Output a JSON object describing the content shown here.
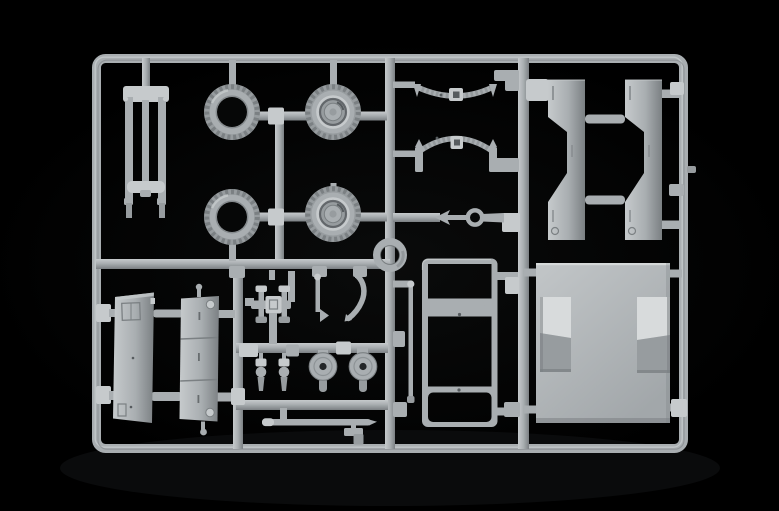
{
  "scene": {
    "description": "Product photograph of an unassembled light-gray injection-molded plastic model kit sprue (parts tree) lying on a black background",
    "background_color": "#000000",
    "material": "light gray polystyrene plastic",
    "frame_shape": "rounded rectangular runner frame with internal vertical and horizontal runners"
  },
  "colors": {
    "background": "#000000",
    "plastic": "#a9aeb1",
    "plastic_light": "#c6cacc",
    "plastic_lighter": "#d8dbdc",
    "plastic_mid": "#979c9f",
    "plastic_dark": "#7b8083",
    "plastic_darker": "#565b5e",
    "hole": "#060707",
    "floor_light": "#c2c6c8",
    "floor_mid": "#a2a7aa",
    "shadow_glow": "#0e0f10"
  },
  "sprue": {
    "rows": [
      {
        "location": "top-left",
        "parts_summary": "ladder-shaped support part with two legs"
      },
      {
        "location": "top-center-left",
        "parts_summary": "two hollow tires and two wheels with molded hubs"
      },
      {
        "location": "top-center",
        "parts_summary": "two curved leaf-spring parts, one bowed down and one arched up"
      },
      {
        "location": "top-right",
        "parts_summary": "two tall notched chassis-rail panels"
      },
      {
        "location": "middle",
        "parts_summary": "towing rod with ring eyelet and a round ring part"
      },
      {
        "location": "bottom-left",
        "parts_summary": "two door panels with hinge and panel detailing"
      },
      {
        "location": "bottom-center",
        "parts_summary": "cluster of small parts: cross fitting, levers, pins, two drilled discs, long thin rod, stepped bracket"
      },
      {
        "location": "bottom-center-right",
        "parts_summary": "three-opening window frame and a thin rod"
      },
      {
        "location": "bottom-right",
        "parts_summary": "large floor panel with two raised box shapes"
      }
    ],
    "parts": [
      {
        "name": "ladder-support-part",
        "count": 1
      },
      {
        "name": "tire",
        "count": 2
      },
      {
        "name": "wheel-with-hub",
        "count": 2
      },
      {
        "name": "leaf-spring-bowed-down",
        "count": 1
      },
      {
        "name": "leaf-spring-arched-up",
        "count": 1
      },
      {
        "name": "chassis-rail-panel",
        "count": 2
      },
      {
        "name": "towing-rod-with-ring",
        "count": 1
      },
      {
        "name": "round-ring-part",
        "count": 1
      },
      {
        "name": "door-panel",
        "count": 2
      },
      {
        "name": "cross-axle-fitting",
        "count": 1
      },
      {
        "name": "lever-with-flag",
        "count": 1
      },
      {
        "name": "curved-hand-lever",
        "count": 1
      },
      {
        "name": "small-pin-part",
        "count": 2
      },
      {
        "name": "drilled-disc",
        "count": 2
      },
      {
        "name": "long-thin-rod-part",
        "count": 1
      },
      {
        "name": "stepped-bracket",
        "count": 1
      },
      {
        "name": "window-frame-panel",
        "count": 1
      },
      {
        "name": "thin-support-rod",
        "count": 1
      },
      {
        "name": "floor-panel-with-boxes",
        "count": 1
      }
    ]
  }
}
